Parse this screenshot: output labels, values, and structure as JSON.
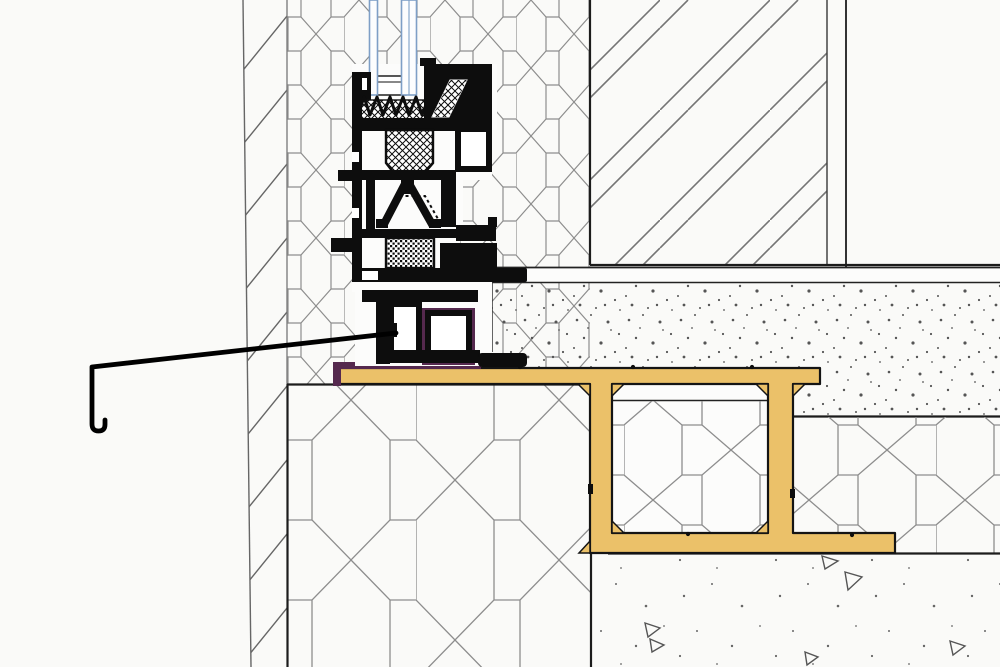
{
  "drawing": {
    "kind": "architectural-section-detail",
    "subject": "window-frame-and-sill-threshold-junction",
    "visible_text": [],
    "components": {
      "glazing": "insulated-glass-unit-edge",
      "frame": "aluminium-window-frame-profile-section",
      "thermal_breaks": "cross-hatched-and-grid-hatched-insert-blocks",
      "membrane": "sealing-membrane-under-frame",
      "sill_profile": "yellow-channel-sill-profile",
      "flashing": "exterior-drip-edge-flashing",
      "wall_left": "insulated-jamb-with-hexagonal-hatch",
      "wall_right": "masonry-wall-diagonal-pair-hatch",
      "screed": "stippled-concrete-screed-layer",
      "insulation_lower": "large-hexagonal-hatch-insulation-blocks",
      "subsoil": "sparse-stipple-concrete-with-triangle-aggregate-marks"
    },
    "colors": {
      "bg": "#fafaf8",
      "paper": "#fcfcfb",
      "ink": "#0d0d0d",
      "line": "#1c1c1c",
      "hatch": "#8d8d8d",
      "wallhatch": "#757575",
      "stipple": "#555555",
      "sill_yellow": "#ebc169",
      "membrane_purple": "#55294e",
      "glass_blue": "#7e9fc6",
      "glass_fill": "#fcfdfe",
      "white": "#ffffff"
    },
    "counts": {
      "glass_panes": 2,
      "gasket_teeth": 7,
      "subsoil_triangles": 6,
      "sill_channel_legs": 2
    }
  }
}
